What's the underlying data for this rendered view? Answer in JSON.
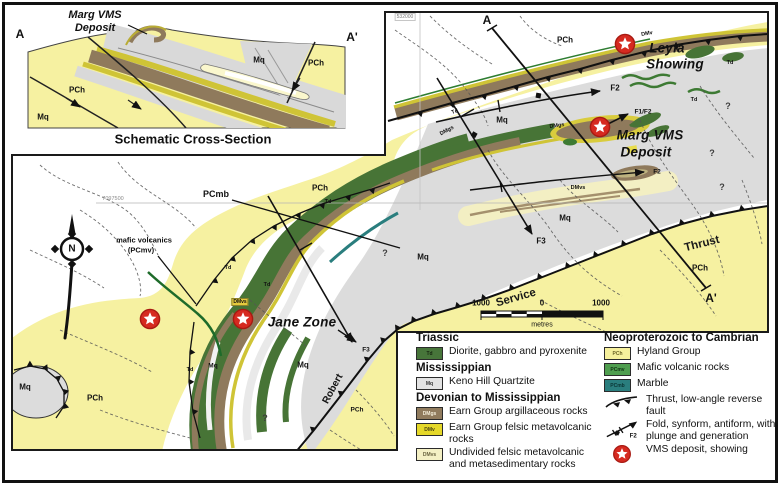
{
  "cross_section": {
    "title": "Schematic Cross-Section",
    "labels": [
      {
        "t": "A",
        "x": 20,
        "y": 34,
        "c": "endpoint",
        "n": "section-end-a"
      },
      {
        "t": "A'",
        "x": 352,
        "y": 37,
        "c": "endpoint",
        "n": "section-end-a-prime"
      },
      {
        "t": "Marg VMS",
        "x": 95,
        "y": 15,
        "c": "xs-big",
        "n": "xs-marg-vms-deposit"
      },
      {
        "t": "Deposit",
        "x": 95,
        "y": 28,
        "c": "xs-big",
        "n": "xs-marg-vms-deposit"
      },
      {
        "t": "Mq",
        "x": 259,
        "y": 60,
        "c": "xs-unit",
        "n": "xs-unit-mq"
      },
      {
        "t": "PCh",
        "x": 316,
        "y": 63,
        "c": "xs-unit",
        "n": "xs-unit-pch"
      },
      {
        "t": "PCh",
        "x": 77,
        "y": 90,
        "c": "xs-unit",
        "n": "xs-unit-pch"
      },
      {
        "t": "Mq",
        "x": 43,
        "y": 117,
        "c": "xs-unit",
        "n": "xs-unit-mq"
      }
    ]
  },
  "map": {
    "compass_letter": "N",
    "labels": [
      {
        "t": "A",
        "x": 487,
        "y": 20,
        "c": "endpoint",
        "n": "section-end-a"
      },
      {
        "t": "A'",
        "x": 711,
        "y": 298,
        "c": "endpoint",
        "n": "section-end-a-prime"
      },
      {
        "t": "Leyla",
        "x": 667,
        "y": 48,
        "c": "big",
        "n": "leyla-showing-label"
      },
      {
        "t": "Showing",
        "x": 675,
        "y": 64,
        "c": "big",
        "n": "leyla-showing-label"
      },
      {
        "t": "Marg VMS",
        "x": 650,
        "y": 135,
        "c": "big",
        "n": "marg-vms-deposit-label"
      },
      {
        "t": "Deposit",
        "x": 646,
        "y": 152,
        "c": "big",
        "n": "marg-vms-deposit-label"
      },
      {
        "t": "Jane Zone",
        "x": 302,
        "y": 322,
        "c": "big",
        "n": "jane-zone-label"
      },
      {
        "t": "F2",
        "x": 615,
        "y": 88,
        "c": "fold",
        "n": "fold-f2-label"
      },
      {
        "t": "F1/F2",
        "x": 643,
        "y": 112,
        "c": "fold-sm",
        "n": "fold-f1-f2-label"
      },
      {
        "t": "F2",
        "x": 657,
        "y": 172,
        "c": "fold-sm",
        "n": "fold-f2-label"
      },
      {
        "t": "F3",
        "x": 541,
        "y": 241,
        "c": "fold",
        "n": "fold-f3-label"
      },
      {
        "t": "F3",
        "x": 366,
        "y": 350,
        "c": "fold-sm",
        "n": "fold-f3-label"
      },
      {
        "t": "Mq",
        "x": 502,
        "y": 120,
        "c": "unit",
        "n": "unit-mq"
      },
      {
        "t": "Mq",
        "x": 565,
        "y": 218,
        "c": "unit",
        "n": "unit-mq"
      },
      {
        "t": "Mq",
        "x": 423,
        "y": 257,
        "c": "unit",
        "n": "unit-mq"
      },
      {
        "t": "Mq",
        "x": 303,
        "y": 365,
        "c": "unit",
        "n": "unit-mq"
      },
      {
        "t": "Mq",
        "x": 25,
        "y": 387,
        "c": "unit",
        "n": "unit-mq"
      },
      {
        "t": "Mq",
        "x": 213,
        "y": 366,
        "c": "unit-sm",
        "n": "unit-mq"
      },
      {
        "t": "PCh",
        "x": 565,
        "y": 40,
        "c": "unit",
        "n": "unit-pch"
      },
      {
        "t": "PCh",
        "x": 320,
        "y": 188,
        "c": "unit",
        "n": "unit-pch"
      },
      {
        "t": "PCh",
        "x": 95,
        "y": 398,
        "c": "unit",
        "n": "unit-pch"
      },
      {
        "t": "PCh",
        "x": 700,
        "y": 268,
        "c": "unit",
        "n": "unit-pch"
      },
      {
        "t": "PCh",
        "x": 357,
        "y": 410,
        "c": "unit-sm",
        "n": "unit-pch"
      },
      {
        "t": "PCmb",
        "x": 216,
        "y": 194,
        "c": "unit-md",
        "n": "unit-pcmb"
      },
      {
        "t": "mafic volcanics",
        "x": 144,
        "y": 240,
        "c": "leader",
        "n": "mafic-volcanics-label"
      },
      {
        "t": "(PCmv)",
        "x": 141,
        "y": 250,
        "c": "leader",
        "n": "mafic-volcanics-label"
      },
      {
        "t": "Thrust",
        "x": 702,
        "y": 244,
        "c": "fault-name",
        "r": -14,
        "n": "thrust-fault-label"
      },
      {
        "t": "Service",
        "x": 516,
        "y": 298,
        "c": "fault-name",
        "r": -16,
        "n": "service-fault-label"
      },
      {
        "t": "Robert",
        "x": 333,
        "y": 389,
        "c": "fault-sm",
        "r": -62,
        "n": "robert-fault-label"
      },
      {
        "t": "Td",
        "x": 455,
        "y": 112,
        "c": "unit-tiny",
        "r": -20,
        "n": "unit-td"
      },
      {
        "t": "Td",
        "x": 328,
        "y": 202,
        "c": "unit-tiny",
        "n": "unit-td"
      },
      {
        "t": "Td",
        "x": 228,
        "y": 268,
        "c": "unit-tiny",
        "n": "unit-td"
      },
      {
        "t": "Td",
        "x": 267,
        "y": 285,
        "c": "unit-tiny",
        "n": "unit-td"
      },
      {
        "t": "Td",
        "x": 190,
        "y": 370,
        "c": "unit-tiny",
        "n": "unit-td"
      },
      {
        "t": "Td",
        "x": 730,
        "y": 63,
        "c": "unit-tiny",
        "n": "unit-td"
      },
      {
        "t": "Td",
        "x": 694,
        "y": 100,
        "c": "unit-tiny",
        "n": "unit-td"
      },
      {
        "t": "DMgs",
        "x": 557,
        "y": 126,
        "c": "unit-tiny",
        "r": -8,
        "n": "unit-dmgs"
      },
      {
        "t": "DMgs",
        "x": 447,
        "y": 131,
        "c": "unit-tiny",
        "r": -28,
        "n": "unit-dmgs"
      },
      {
        "t": "DMvs",
        "x": 578,
        "y": 188,
        "c": "unit-tiny",
        "n": "unit-dmvs"
      },
      {
        "t": "DMvs",
        "x": 240,
        "y": 302,
        "c": "unit-box",
        "n": "unit-dmvs"
      },
      {
        "t": "DMv",
        "x": 647,
        "y": 34,
        "c": "unit-tiny",
        "r": -10,
        "n": "unit-dmv"
      },
      {
        "t": "?",
        "x": 728,
        "y": 106,
        "c": "q",
        "n": "query-mark"
      },
      {
        "t": "?",
        "x": 712,
        "y": 153,
        "c": "q",
        "n": "query-mark"
      },
      {
        "t": "?",
        "x": 722,
        "y": 187,
        "c": "q",
        "n": "query-mark"
      },
      {
        "t": "?",
        "x": 385,
        "y": 253,
        "c": "q",
        "n": "query-mark"
      },
      {
        "t": "?",
        "x": 265,
        "y": 418,
        "c": "q",
        "n": "query-mark"
      },
      {
        "t": "7097500",
        "x": 113,
        "y": 199,
        "c": "grid",
        "n": "grid-northing-label"
      },
      {
        "t": "532000",
        "x": 405,
        "y": 17,
        "c": "grid-box",
        "n": "grid-easting-label"
      },
      {
        "t": "1000",
        "x": 481,
        "y": 303,
        "c": "scale",
        "n": "scale-left-value"
      },
      {
        "t": "0",
        "x": 542,
        "y": 303,
        "c": "scale",
        "n": "scale-zero-value"
      },
      {
        "t": "1000",
        "x": 601,
        "y": 303,
        "c": "scale",
        "n": "scale-right-value"
      },
      {
        "t": "metres",
        "x": 542,
        "y": 325,
        "c": "scale-sm",
        "n": "scale-units-label"
      }
    ],
    "stars": [
      {
        "name": "leyla-showing",
        "x": 625,
        "y": 44
      },
      {
        "name": "marg-vms-deposit",
        "x": 600,
        "y": 127
      },
      {
        "name": "jane-zone-west",
        "x": 150,
        "y": 319
      },
      {
        "name": "jane-zone-east",
        "x": 243,
        "y": 319
      }
    ]
  },
  "legend": {
    "left": [
      {
        "type": "header",
        "text": "Triassic"
      },
      {
        "type": "unit",
        "code": "Td",
        "color": "#47753a",
        "tc": "#14240e",
        "label": "Diorite, gabbro and pyroxenite"
      },
      {
        "type": "header",
        "text": "Mississippian"
      },
      {
        "type": "unit",
        "code": "Mq",
        "color": "#e3e3e3",
        "tc": "#333333",
        "label": "Keno Hill Quartzite"
      },
      {
        "type": "header",
        "text": "Devonian to Mississippian"
      },
      {
        "type": "unit",
        "code": "DMgs",
        "color": "#907b5d",
        "tc": "#f3edd9",
        "label": "Earn Group argillaceous rocks"
      },
      {
        "type": "unit",
        "code": "DMv",
        "color": "#e5d829",
        "tc": "#4a4410",
        "label": "Earn Group felsic metavolcanic rocks"
      },
      {
        "type": "unit",
        "code": "DMvs",
        "color": "#f4f0c4",
        "tc": "#6a6440",
        "label": "Undivided felsic metavolcanic and metasedimentary rocks"
      }
    ],
    "right": [
      {
        "type": "header",
        "text": "Neoproterozoic to Cambrian"
      },
      {
        "type": "unit",
        "code": "PCh",
        "color": "#f6f09c",
        "tc": "#6b6426",
        "label": "Hyland Group"
      },
      {
        "type": "unit",
        "code": "PCmv",
        "color": "#4f9e4f",
        "tc": "#0e3313",
        "label": "Mafic volcanic rocks"
      },
      {
        "type": "unit",
        "code": "PCmb",
        "color": "#2a7e7e",
        "tc": "#0a3434",
        "label": "Marble"
      },
      {
        "type": "symbol",
        "symbol": "thrust",
        "label": "Thrust, low-angle reverse fault"
      },
      {
        "type": "symbol",
        "symbol": "fold",
        "sublabel": "F2",
        "label": "Fold, synform, antiform, with plunge and generation"
      },
      {
        "type": "symbol",
        "symbol": "star",
        "label": "VMS deposit, showing"
      }
    ]
  },
  "colors": {
    "pch_yellow": "#f6f1a1",
    "mq_gray": "#dcdcdc",
    "td_green": "#477436",
    "dmgs_brown": "#8f7a5c",
    "dmv_yellow": "#d9cc3d",
    "dmvs_pale": "#f3efc3",
    "pcmv_green": "#2e7d32",
    "pcmb_teal": "#2a7e7e",
    "star_red": "#d62a20"
  }
}
